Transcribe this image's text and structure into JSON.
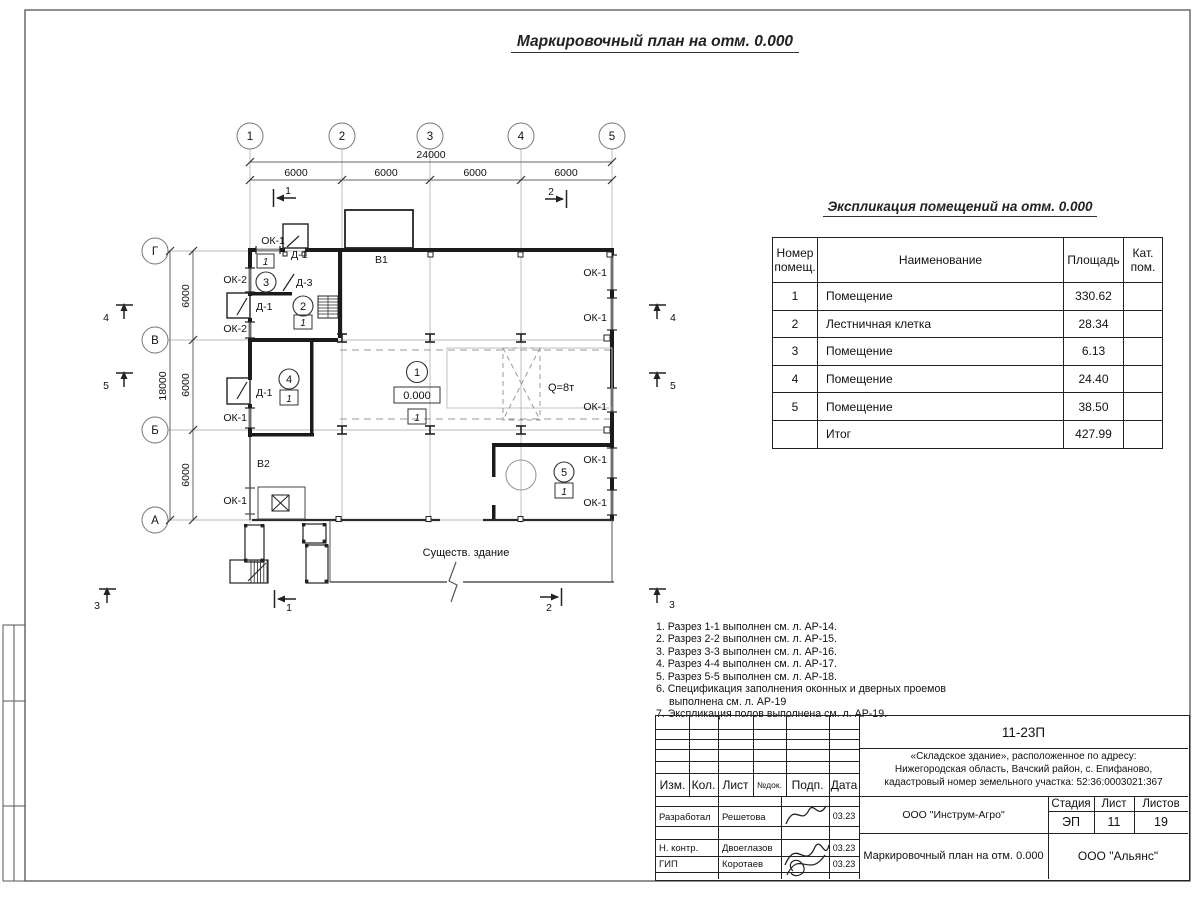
{
  "titles": {
    "plan": "Маркировочный план на отм. 0.000",
    "explication": "Экспликация помещений на отм. 0.000"
  },
  "axes": {
    "top": [
      "1",
      "2",
      "3",
      "4",
      "5"
    ],
    "left": [
      "Г",
      "В",
      "Б",
      "А"
    ]
  },
  "dims": {
    "total_width": "24000",
    "bay": "6000",
    "total_height": "18000"
  },
  "plan_labels": {
    "ok1": "ОК-1",
    "ok2": "ОК-2",
    "d1": "Д-1",
    "d3": "Д-3",
    "v1": "В1",
    "v2": "В2",
    "crane": "Q=8т",
    "elevation": "0.000",
    "floor_mark": "1",
    "existing_building": "Существ. здание"
  },
  "rooms": [
    "1",
    "2",
    "3",
    "4",
    "5"
  ],
  "sections": [
    "1",
    "2",
    "3",
    "4",
    "5"
  ],
  "explication": {
    "headers": {
      "num1": "Номер",
      "num2": "помещ.",
      "name": "Наименование",
      "area": "Площадь",
      "cat1": "Кат.",
      "cat2": "пом."
    },
    "rows": [
      {
        "num": "1",
        "name": "Помещение",
        "area": "330.62",
        "cat": ""
      },
      {
        "num": "2",
        "name": "Лестничная клетка",
        "area": "28.34",
        "cat": ""
      },
      {
        "num": "3",
        "name": "Помещение",
        "area": "6.13",
        "cat": ""
      },
      {
        "num": "4",
        "name": "Помещение",
        "area": "24.40",
        "cat": ""
      },
      {
        "num": "5",
        "name": "Помещение",
        "area": "38.50",
        "cat": ""
      },
      {
        "num": "",
        "name": "Итог",
        "area": "427.99",
        "cat": ""
      }
    ]
  },
  "notes": [
    "1. Разрез 1-1 выполнен см. л. АР-14.",
    "2. Разрез 2-2 выполнен см. л. АР-15.",
    "3. Разрез 3-3 выполнен см. л. АР-16.",
    "4. Разрез 4-4 выполнен см. л. АР-17.",
    "5. Разрез 5-5 выполнен см. л. АР-18.",
    "6. Спецификация заполнения оконных и дверных проемов выполнена см. л. АР-19",
    "7. Экспликация полов выполнена см. л. АР-19."
  ],
  "titleblock": {
    "doc_number": "11-23П",
    "project_line1": "«Складское здание», расположенное по адресу:",
    "project_line2": "Нижегородская область, Вачский район, с. Епифаново,",
    "project_line3": "кадастровый номер земельного участка: 52:36:0003021:367",
    "col_izm": "Изм.",
    "col_kol": "Кол.",
    "col_list": "Лист",
    "col_ndok": "№док.",
    "col_podp": "Подп.",
    "col_data": "Дата",
    "rows": [
      {
        "role": "Разработал",
        "name": "Решетова",
        "date": "03.23"
      },
      {
        "role": "Н. контр.",
        "name": "Двоеглазов",
        "date": "03.23"
      },
      {
        "role": "ГИП",
        "name": "Коротаев",
        "date": "03.23"
      }
    ],
    "org": "ООО \"Инструм-Агро\"",
    "stage_label": "Стадия",
    "sheet_label": "Лист",
    "sheets_label": "Листов",
    "stage": "ЭП",
    "sheet_num": "11",
    "sheets_total": "19",
    "drawing_name": "Маркировочный план на отм. 0.000",
    "org2": "ООО \"Альянс\""
  }
}
